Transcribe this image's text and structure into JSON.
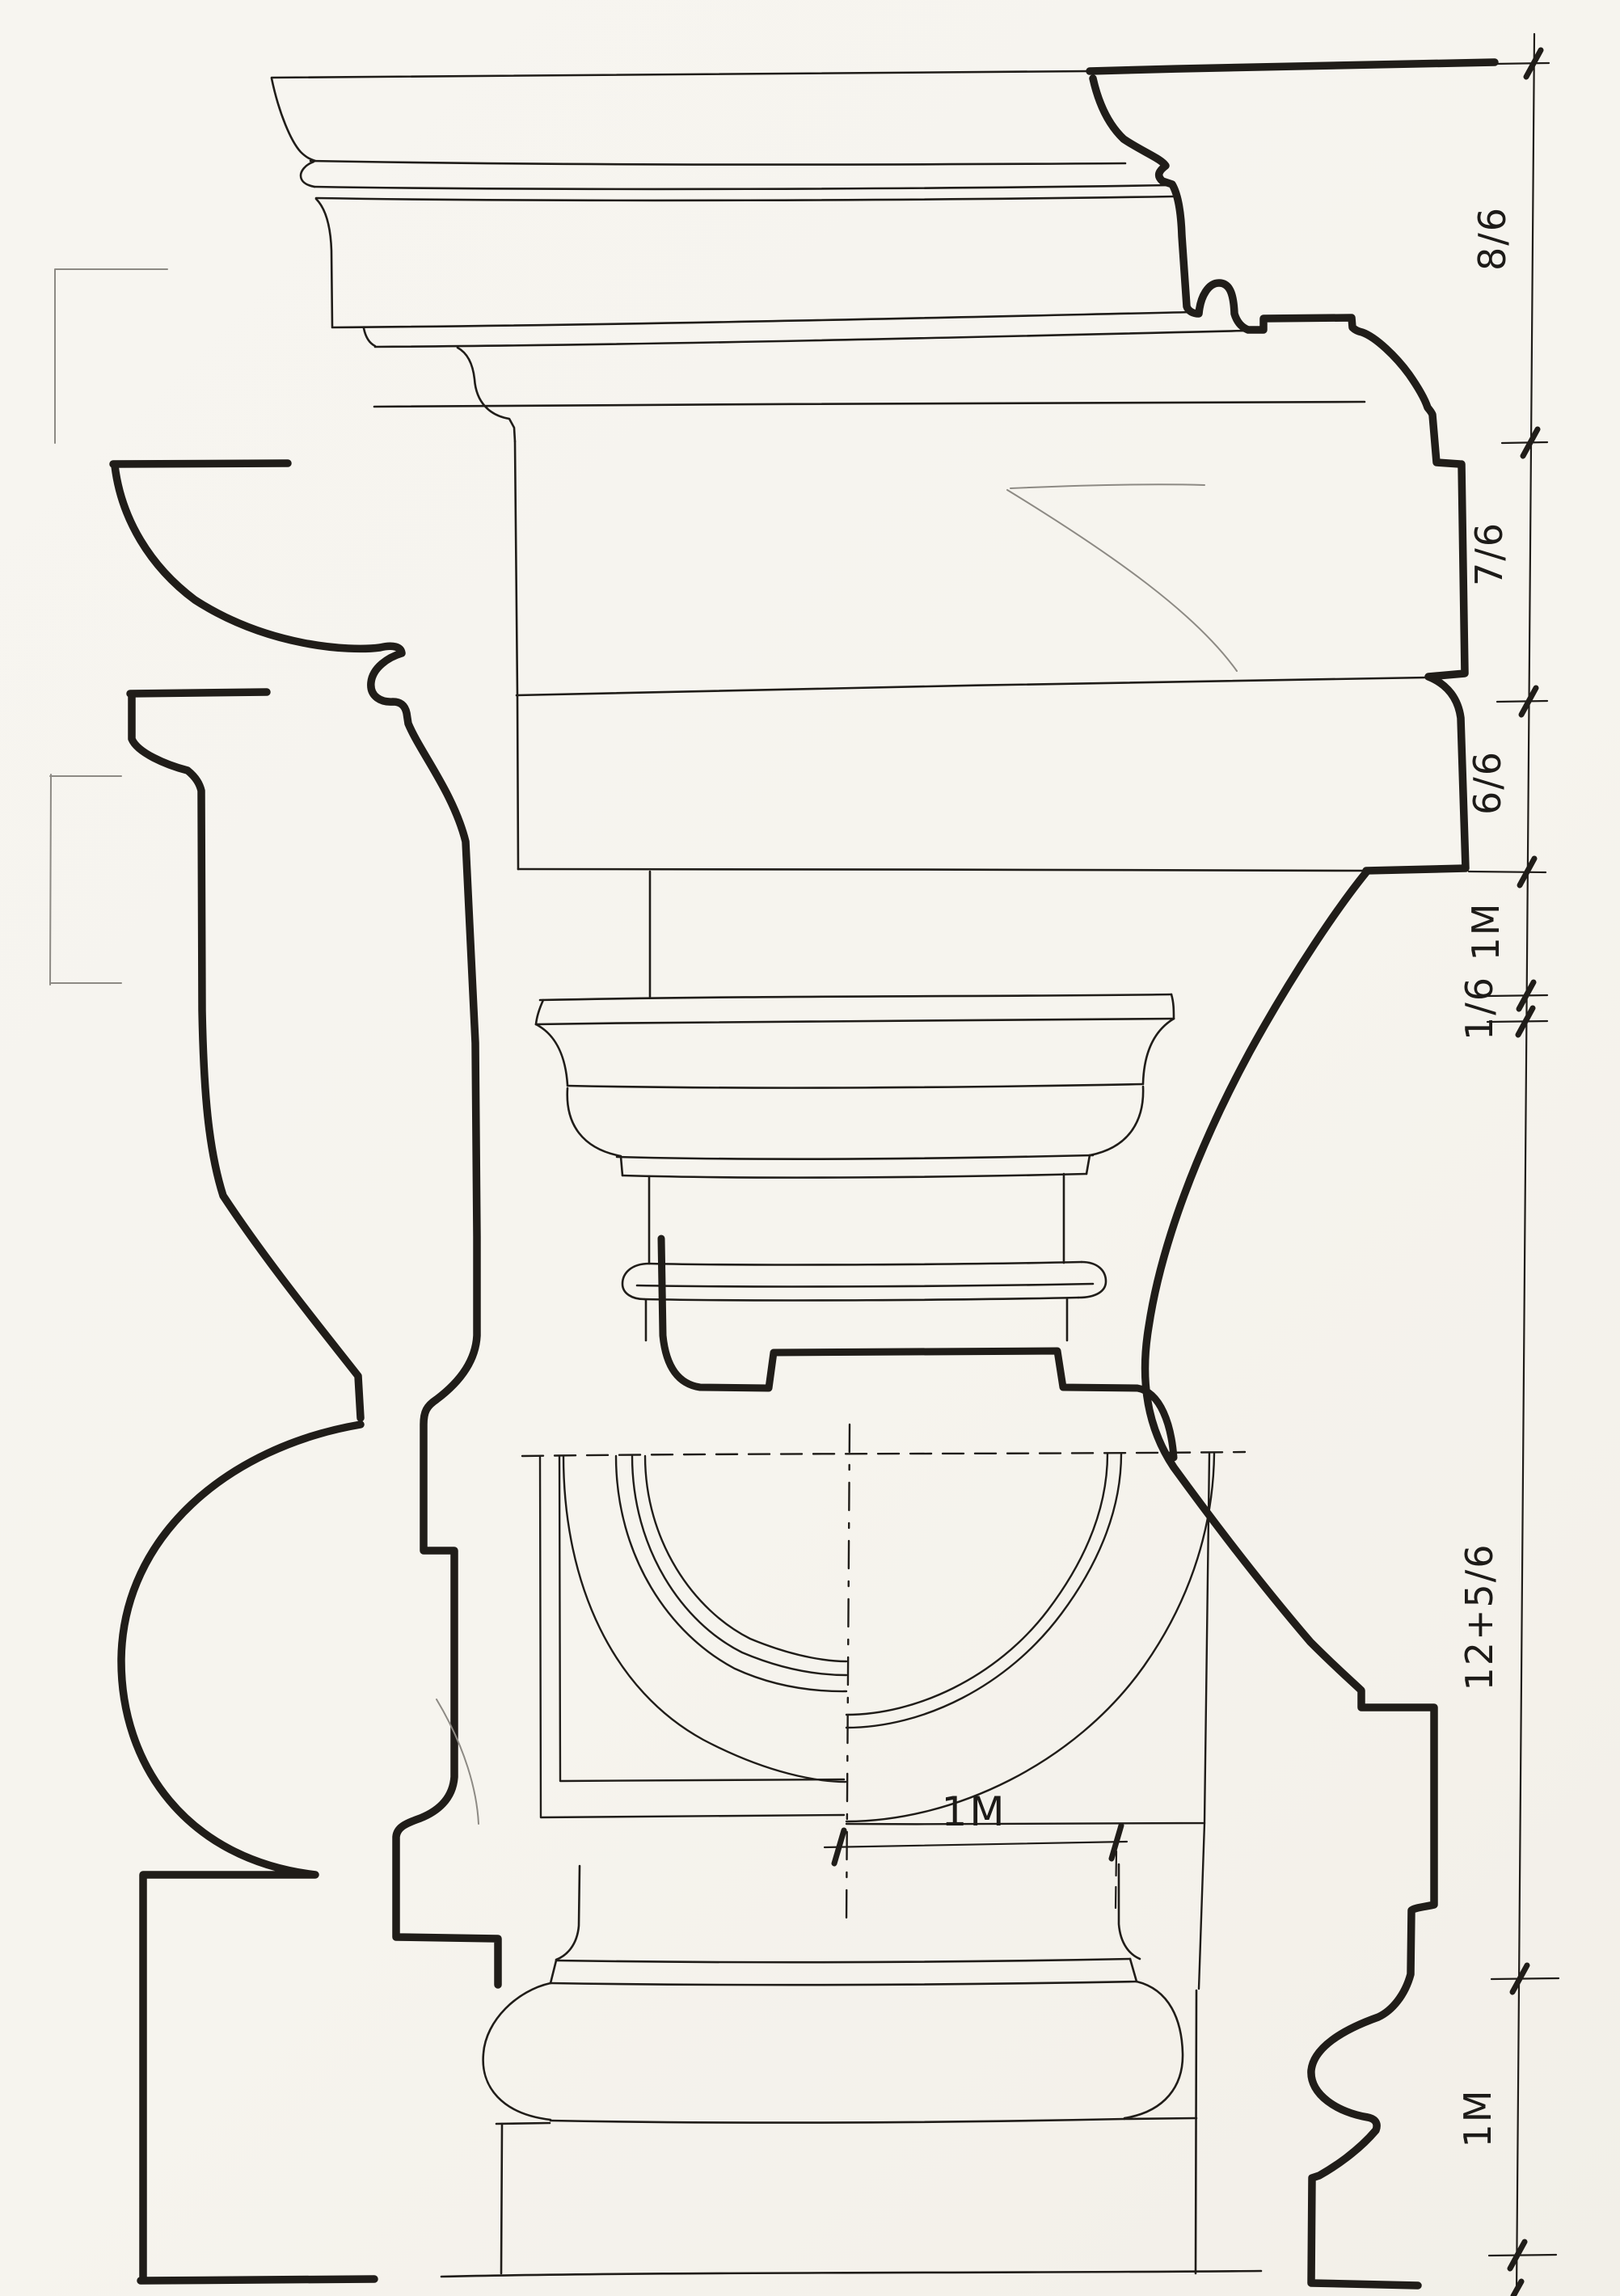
{
  "drawing": {
    "type": "architectural plate — classical column order (entablature, capital, broken shaft with plan, base)",
    "colors": {
      "paper": "#f6f4ee",
      "ink": "#201d19",
      "pencil": "#8d8a84"
    },
    "dimension_column": {
      "labels": [
        {
          "text": "8/6"
        },
        {
          "text": "7/6"
        },
        {
          "text": "6/6"
        },
        {
          "text": "1M"
        },
        {
          "text": "1/6"
        },
        {
          "text": "12+5/6"
        },
        {
          "text": "1M"
        }
      ]
    },
    "plan_dimension": {
      "text": "1M"
    }
  }
}
